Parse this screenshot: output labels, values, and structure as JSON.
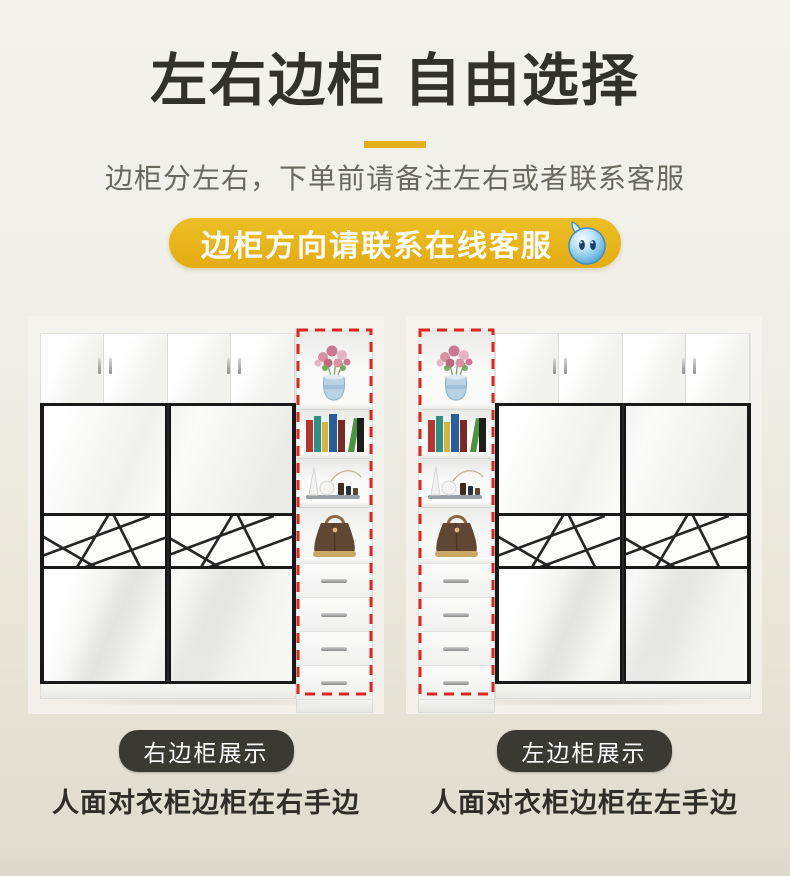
{
  "header": {
    "title": "左右边柜 自由选择",
    "subtitle": "边柜分左右，下单前请备注左右或者联系客服",
    "service_badge": "边柜方向请联系在线客服"
  },
  "products": [
    {
      "badge": "右边柜展示",
      "caption": "人面对衣柜边柜在右手边",
      "cabinet_side": "right"
    },
    {
      "badge": "左边柜展示",
      "caption": "人面对衣柜边柜在左手边",
      "cabinet_side": "left"
    }
  ],
  "colors": {
    "accent_yellow": "#e8b51e",
    "divider_yellow": "#e2b01c",
    "highlight_red": "#e32222",
    "dark_badge": "#3b3a32",
    "title_text": "#33312c",
    "subtitle_text": "#6b695f"
  },
  "icons": {
    "service_mascot": "water-drop-mascot-icon"
  }
}
